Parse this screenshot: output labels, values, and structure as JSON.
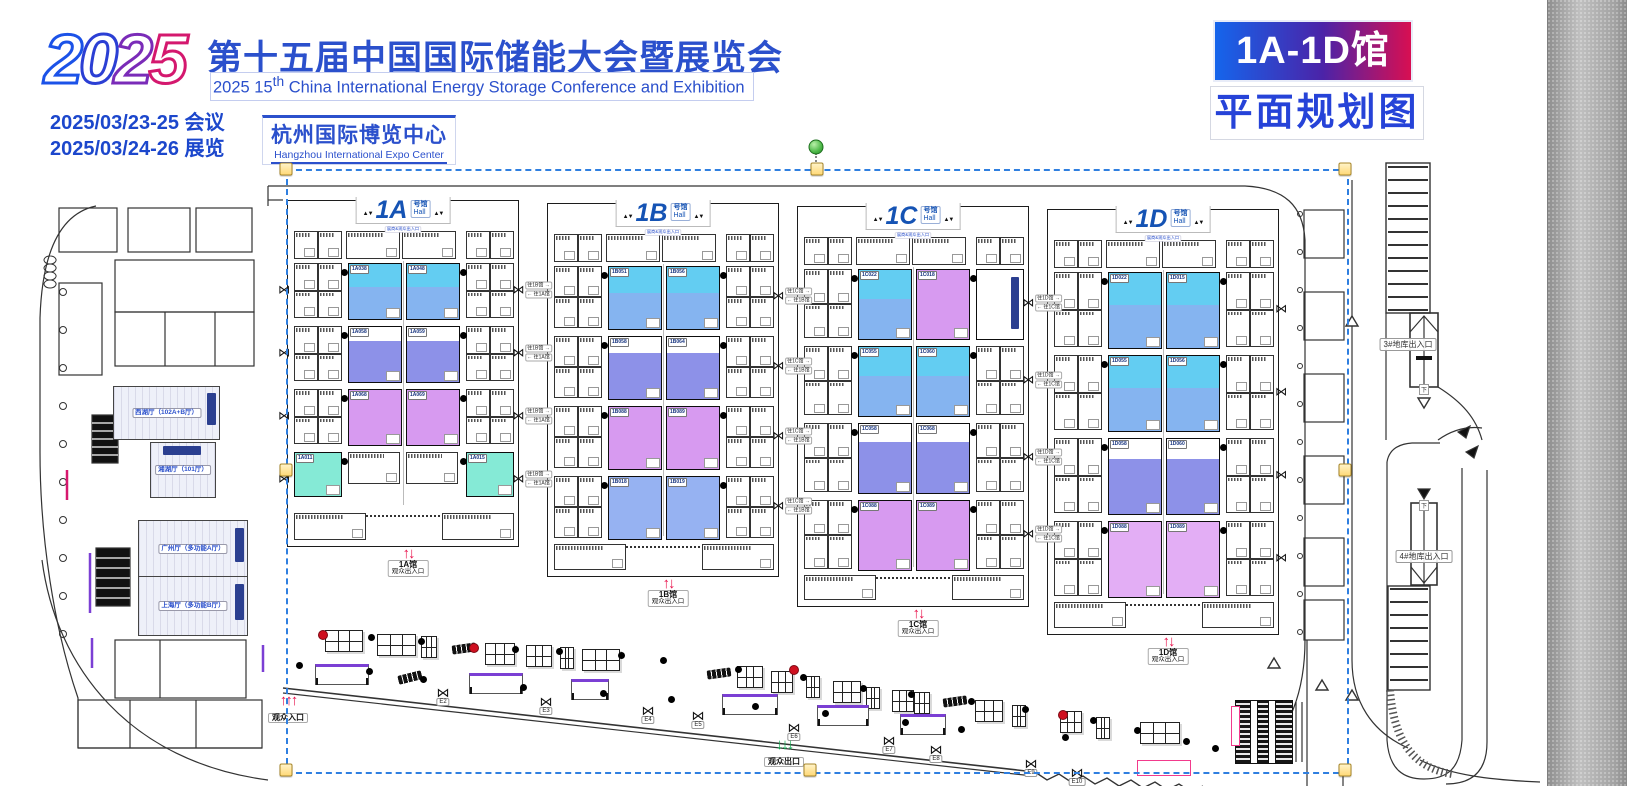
{
  "header": {
    "year": "2025",
    "title_cn": "第十五届中国国际储能大会暨展览会",
    "title_en_prefix": "2025 15",
    "title_en_sup": "th",
    "title_en_rest": " China International Energy Storage Conference and Exhibition",
    "date_conference": "2025/03/23-25 会议",
    "date_exhibition": "2025/03/24-26 展览",
    "venue_cn": "杭州国际博览中心",
    "venue_en": "Hangzhou International Expo Center",
    "badge_halls": "1A-1D馆",
    "badge_plan": "平面规划图"
  },
  "colors": {
    "cyan": "#63cdf2",
    "blue": "#85b4f0",
    "periwinkle": "#8d91e8",
    "magenta": "#d79af0",
    "magenta_light": "#e3aef5",
    "blue_solid": "#96b2f2",
    "mint": "#85ead6",
    "navy": "#2b3f90"
  },
  "halls": [
    {
      "name": "1A",
      "suffix_cn": "号馆",
      "suffix_en": "Hall",
      "gate_note": "展商&观众出入口",
      "entrance_line1": "1A馆",
      "entrance_line2": "观众出入口",
      "groups": [
        {
          "type": "split",
          "codes": [
            "1A038",
            "1A048"
          ]
        },
        {
          "type": "peri",
          "codes": [
            "1A058",
            "1A059"
          ]
        },
        {
          "type": "magenta",
          "codes": [
            "1A068",
            "1A069"
          ]
        },
        {
          "type": "mintEdges",
          "codes": [
            "1A011",
            "1A015"
          ]
        }
      ]
    },
    {
      "name": "1B",
      "suffix_cn": "号馆",
      "suffix_en": "Hall",
      "gate_note": "展商&观众出入口",
      "entrance_line1": "1B馆",
      "entrance_line2": "观众出入口",
      "groups": [
        {
          "type": "split",
          "codes": [
            "1B051",
            "1B056"
          ]
        },
        {
          "type": "peri",
          "codes": [
            "1B058",
            "1B064"
          ]
        },
        {
          "type": "magenta",
          "codes": [
            "1B088",
            "1B089"
          ]
        },
        {
          "type": "blue",
          "codes": [
            "1B018",
            "1B019"
          ]
        }
      ]
    },
    {
      "name": "1C",
      "suffix_cn": "号馆",
      "suffix_en": "Hall",
      "gate_note": "展商&观众出入口",
      "entrance_line1": "1C馆",
      "entrance_line2": "观众出入口",
      "groups": [
        {
          "type": "splitMagenta",
          "codes": [
            "1C022",
            "1C018"
          ]
        },
        {
          "type": "split",
          "codes": [
            "1C055",
            "1C060"
          ]
        },
        {
          "type": "peri",
          "codes": [
            "1C058",
            "1C068"
          ]
        },
        {
          "type": "magentaTall",
          "codes": [
            "1C088",
            "1C089"
          ]
        }
      ]
    },
    {
      "name": "1D",
      "suffix_cn": "号馆",
      "suffix_en": "Hall",
      "gate_note": "展商&观众出入口",
      "entrance_line1": "1D馆",
      "entrance_line2": "观众出入口",
      "groups": [
        {
          "type": "split",
          "codes": [
            "1D022",
            "1D015"
          ]
        },
        {
          "type": "split",
          "codes": [
            "1D055",
            "1D056"
          ]
        },
        {
          "type": "peri",
          "codes": [
            "1D058",
            "1D060"
          ]
        },
        {
          "type": "magentaLight",
          "codes": [
            "1D088",
            "1D089"
          ]
        }
      ]
    }
  ],
  "corridors": [
    {
      "to_right": "往1B馆",
      "to_left": "往1A馆"
    },
    {
      "to_right": "往1C馆",
      "to_left": "往1B馆"
    },
    {
      "to_right": "往1D馆",
      "to_left": "往1C馆"
    }
  ],
  "left_wing": {
    "rooms": [
      {
        "name": "西湖厅（102A+B厅）"
      },
      {
        "name": "湘湖厅（101厅）"
      },
      {
        "name": "广州厅（多功能A厅）"
      },
      {
        "name": "上海厅（多功能B厅）"
      }
    ]
  },
  "outdoor": {
    "visitor_entrance": "观众入口",
    "visitor_exit": "观众出口",
    "doors": [
      "E2",
      "E3",
      "E4",
      "E5",
      "E6",
      "E7",
      "E8",
      "E9",
      "E10"
    ]
  },
  "right_side": {
    "garage_3": "3#地库出入口",
    "garage_4": "4#地库出入口",
    "down_label": "下"
  }
}
